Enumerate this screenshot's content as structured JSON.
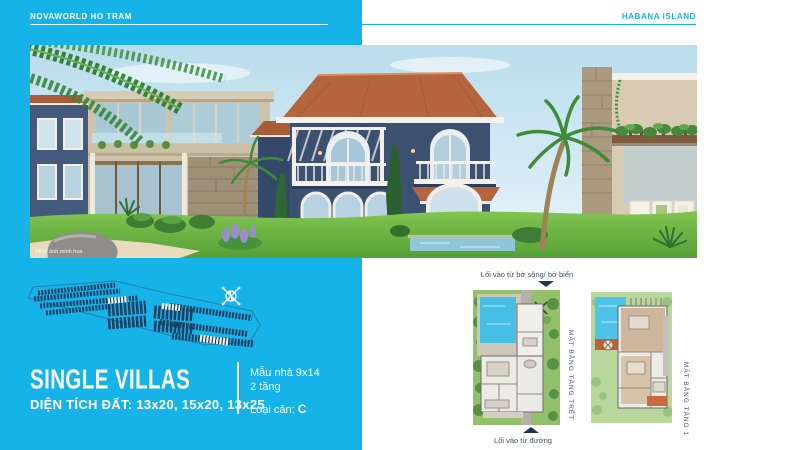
{
  "header": {
    "left_title": "NOVAWORLD HO TRAM",
    "right_title": "HABANA ISLAND"
  },
  "hero": {
    "watermark": "Hình ảnh minh họa"
  },
  "info": {
    "title": "SINGLE VILLAS",
    "land_area": "DIỆN TÍCH ĐẤT: 13x20, 15x20, 13x25",
    "model": "Mẫu nhà 9x14",
    "floors": "2 tầng",
    "unit_type_label": "Loại căn:",
    "unit_type_value": "C"
  },
  "plans": {
    "entry_top": "Lối vào từ bờ sông/ bờ biển",
    "entry_bottom": "Lối vào từ đường",
    "ground_label": "MẶT BẰNG TẦNG TRỆT",
    "first_label": "MẶT BẰNG TẦNG 1"
  },
  "colors": {
    "accent_cyan": "#16b3e8",
    "navy_lots": "#1c3f63",
    "villa_wall": "#3c5172",
    "roof_terracotta": "#b4653d",
    "label_text": "#3f4f63"
  }
}
